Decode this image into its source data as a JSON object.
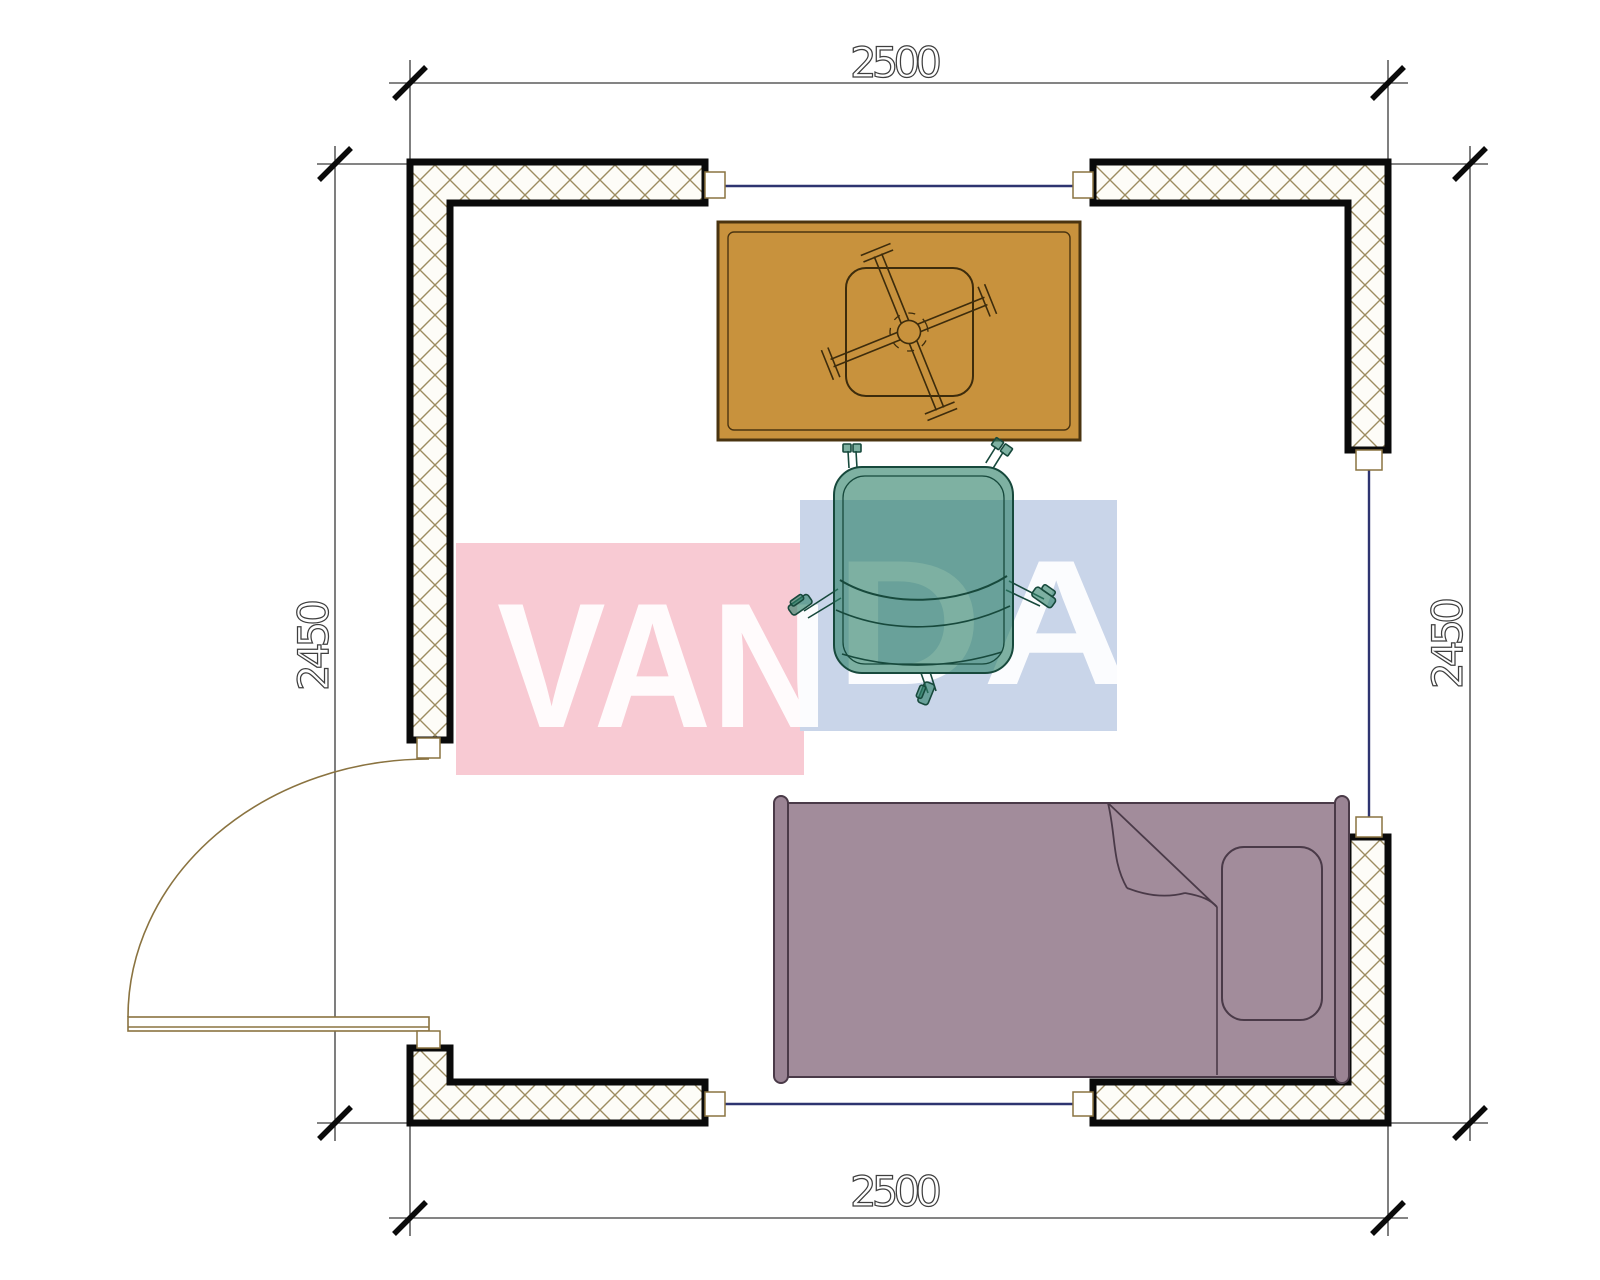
{
  "title": "room-floor-plan",
  "dimensions": {
    "top": "2500",
    "bottom": "2500",
    "left": "2450",
    "right": "2450"
  },
  "watermark": {
    "part1": "VAN",
    "part2": "DA",
    "pink": "#F8CAD3",
    "blue": "#C9D5E9",
    "letter_color": "#FFFFFF"
  },
  "colors": {
    "wall_outline": "#0A0A0A",
    "wall_hatch": "#9C8C60",
    "window": "#2E3470",
    "door": "#8A7340",
    "dimension": "#3F3F3F",
    "table_top": "#C8923D",
    "table_outline": "#4A3410",
    "chair": "#2F8169",
    "chair_outline": "#17493C",
    "bed": "#A28C9B",
    "bed_rail": "#9A8494",
    "bed_outline": "#4A3A48"
  },
  "furniture": [
    "table-with-cross-base",
    "office-chair",
    "single-bed"
  ],
  "openings": [
    "door-bottom-left",
    "window-top",
    "window-bottom",
    "window-right"
  ]
}
